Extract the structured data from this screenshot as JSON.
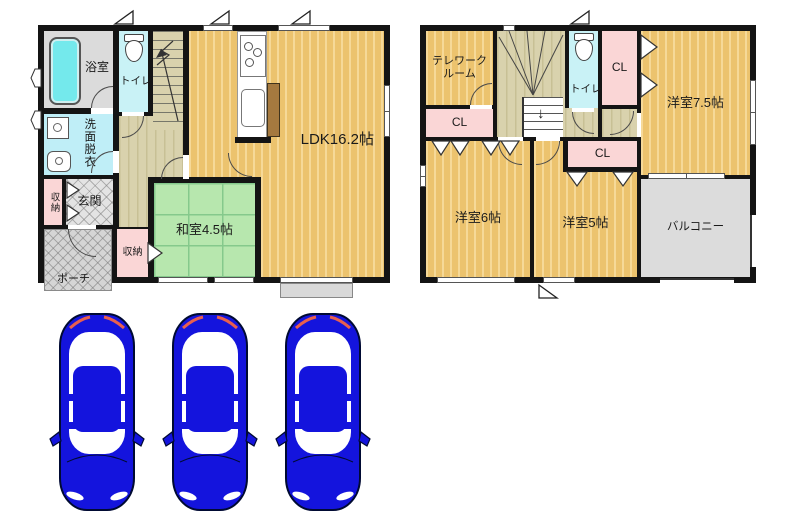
{
  "title": "2-story house floor plan with 3-car parking",
  "floor1": {
    "bath": "浴室",
    "toilet": "トイレ",
    "wash": "洗面脱衣",
    "closet_left": "収納",
    "genkan": "玄関",
    "porch": "ポーチ",
    "closet_bottom": "収納",
    "washitsu": "和室4.5帖",
    "ldk": "LDK16.2帖"
  },
  "floor2": {
    "telework1": "テレワーク",
    "telework2": "ルーム",
    "cl_left": "CL",
    "cl_top": "CL",
    "toilet": "トイレ",
    "room75": "洋室7.5帖",
    "room6": "洋室6帖",
    "room5": "洋室5帖",
    "cl5": "CL",
    "balcony": "バルコニー"
  },
  "parking": {
    "car_count": 3
  },
  "icons": {
    "bathtub": "bathtub-icon",
    "toilet": "toilet-icon",
    "washer": "washing-machine-icon",
    "basin": "washbasin-icon",
    "stove": "stove-icon",
    "sink": "kitchen-sink-icon",
    "stairs": "stairs-icon",
    "car": "car-top-view-icon"
  },
  "colors": {
    "wall": "#141414",
    "wood_floor": "#ecc36e",
    "wood_stripe": "#f6d998",
    "hallway": "#d9d2ad",
    "tatami": "#b7e7ae",
    "wet_room": "#c9f2f6",
    "washroom": "#bfeef7",
    "bathtub": "#74e9ec",
    "closet_pink": "#fad6d6",
    "entry_gray": "#e3e3e3",
    "porch_gray": "#d5d5d5",
    "balcony_gray": "#dcdcdc",
    "car_blue": "#1414dd",
    "car_tail_red": "#e8604e"
  }
}
